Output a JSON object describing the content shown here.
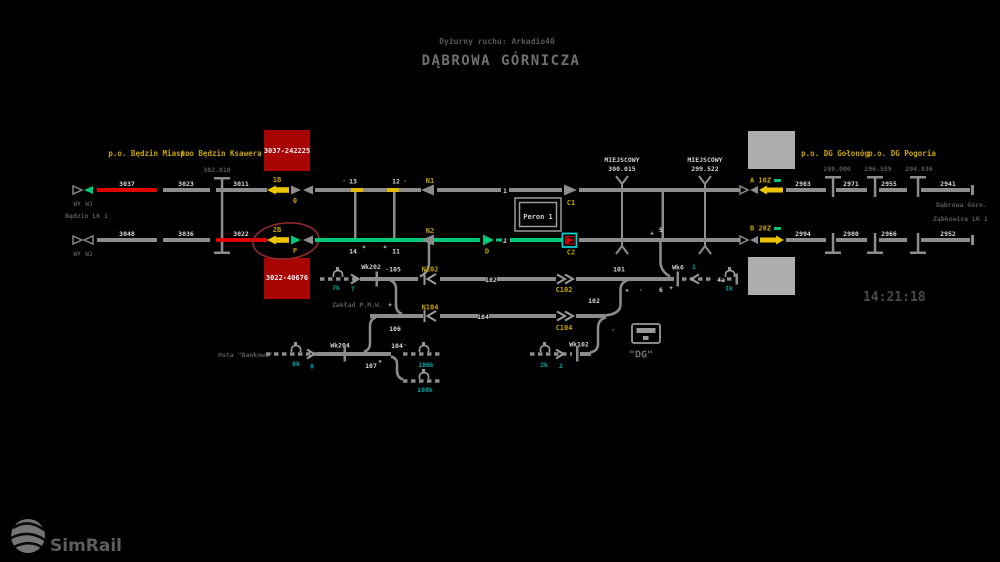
{
  "colors": {
    "route_green": "#00c878",
    "occupied_red": "#e00000",
    "signal_yellow": "#ecc500",
    "label_yellow": "#c9a400",
    "shunt_cyan": "#00a8a8",
    "selected_border": "#00d0d0",
    "track_gray": "#8c8c8c",
    "train_box_red": "#a80404"
  },
  "header": {
    "duty_officer": "Dyżurny ruchu: Arkadio40",
    "station_name": "DĄBROWA GÓRNICZA"
  },
  "clock": {
    "time": "14:21:18"
  },
  "branding": {
    "logo_text": "SimRail"
  },
  "posts": {
    "bedzin_miasto": "p.o. Będzin Miasto",
    "bedzin_ksawera": "p.o Będzin Ksawera",
    "dg_golonog": "p.o. DG Gołonóg",
    "dg_pogoria": "p.o. DG Pogoria"
  },
  "trains": {
    "top": "3037-242225",
    "bottom": "3022-40676"
  },
  "km_posts": {
    "km302": "302.010",
    "km298": "298.000",
    "km296": "296.589",
    "km294": "294.836"
  },
  "crossings": {
    "first": {
      "name": "MIEJSCOWY",
      "km": "300.015"
    },
    "second": {
      "name": "MIEJSCOWY",
      "km": "299.522"
    }
  },
  "area_labels": {
    "bedzin_lk1": "Będzin LK 1",
    "dabrowa_gorn": "Dąbrowa Górn.",
    "zabkowice_lk1": "Ząbkowice LK 1",
    "zaklad_pmw": "Zakład P.M.W.",
    "huta_bankowa": "Huta \"Bankowa\"",
    "dg_sign": "\"DG\"",
    "peron1": "Peron 1"
  },
  "blocks": {
    "top": [
      "3037",
      "3023",
      "3011",
      "2903",
      "2971",
      "2955",
      "2941"
    ],
    "bottom": [
      "3048",
      "3036",
      "3022",
      "2994",
      "2980",
      "2966",
      "2952"
    ]
  },
  "signals": {
    "wy": "WY",
    "wj": "WJ",
    "s1b": "1B",
    "s1b_ind": "0",
    "s2b": "2B",
    "s2b_ind": "P",
    "n1": "N1",
    "n2": "N2",
    "c1": "C1",
    "c2": "C2",
    "d": "D",
    "a": "A 10Z",
    "b": "B 20Z",
    "n102": "N102",
    "c102": "C102",
    "n104": "N104",
    "c104": "C104"
  },
  "wk_posts": {
    "wk202": "Wk202",
    "wk204": "Wk204",
    "wk102": "Wk102",
    "wk6": "Wk6"
  },
  "track_numbers": {
    "t1": "1",
    "t2": "2",
    "t101": "101",
    "t102": "102",
    "t102b": "102",
    "t104": "104",
    "t105": "105",
    "t106": "106",
    "t107": "107",
    "t4a": "4a"
  },
  "switches": {
    "sw13": "13",
    "sw12": "12",
    "sw14": "14",
    "sw11": "11",
    "sw5": "5",
    "sw6": "6",
    "sw104": "104"
  },
  "shunting": {
    "k7": "7k",
    "s7": "7",
    "k1": "1k",
    "s1": "1",
    "k2": "2k",
    "s2": "2",
    "k8": "8k",
    "s8": "8",
    "k106": "106k",
    "k108": "108k"
  },
  "marks": {
    "dot_13": "·",
    "dot_12": "·",
    "star_14": "*",
    "star_11": "*",
    "plus_5": "+",
    "plus_6": "+",
    "dot_6": "·",
    "dot_105": "·",
    "plus_106": "+",
    "star_102": "*",
    "dot_102": "·",
    "dot_104": "·",
    "star_107": "*"
  }
}
